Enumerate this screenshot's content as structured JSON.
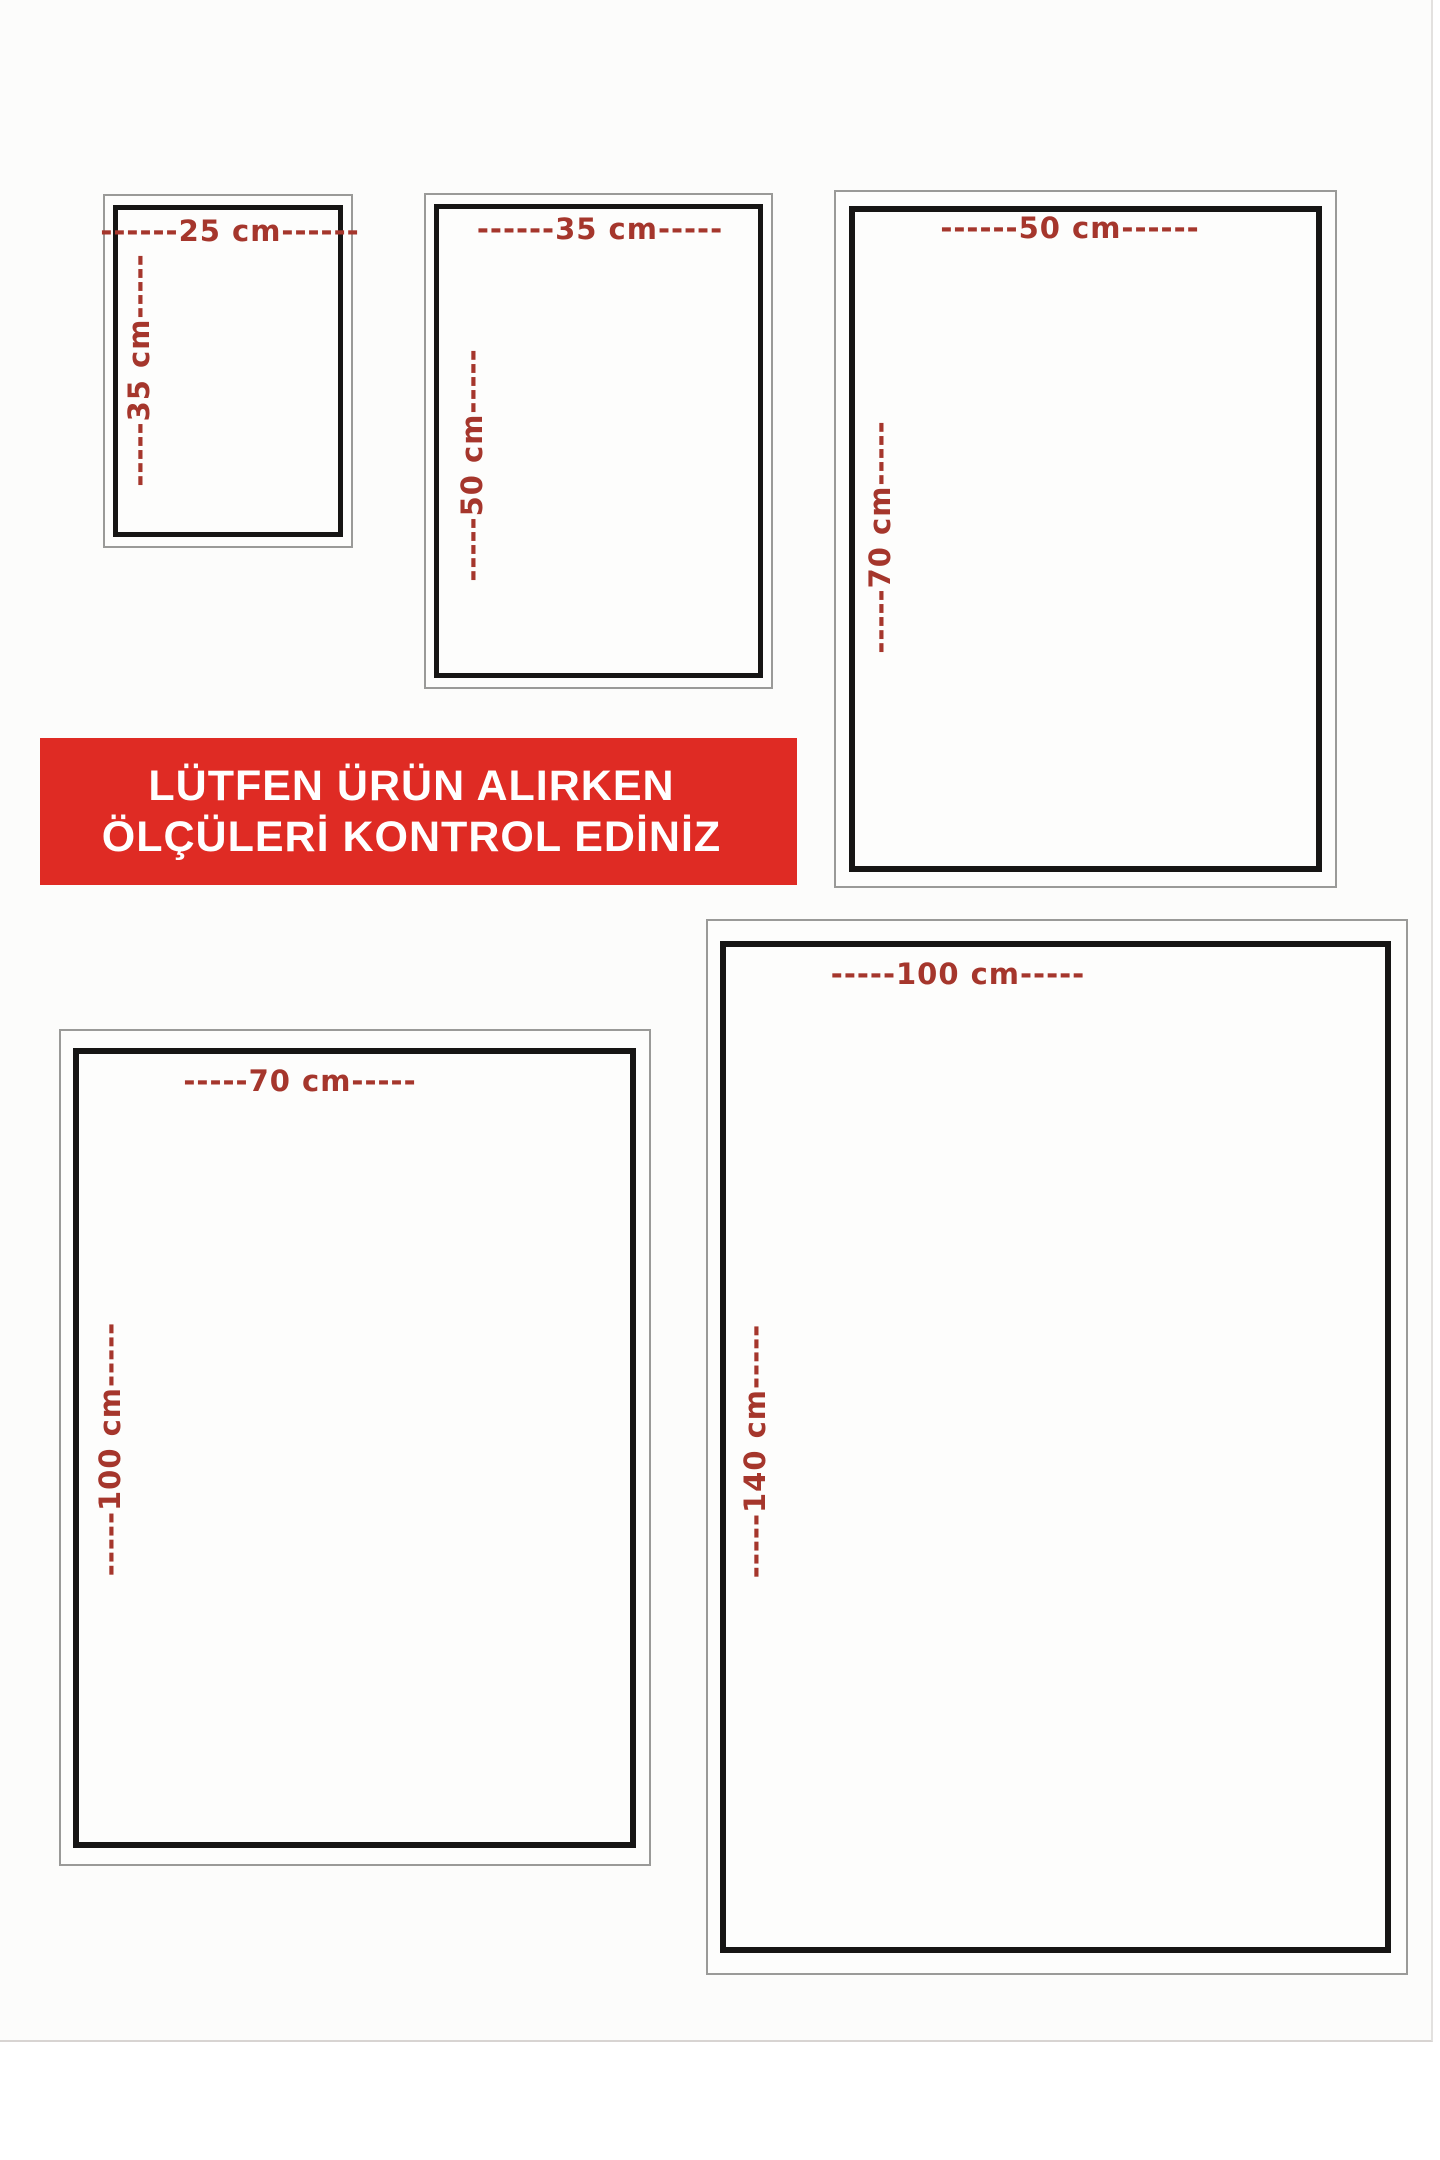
{
  "banner": {
    "line1": "LÜTFEN ÜRÜN ALIRKEN",
    "line2": "ÖLÇÜLERİ KONTROL EDİNİZ",
    "bg_color": "#df2b24",
    "text_color": "#ffffff"
  },
  "label_color": "#a5362c",
  "frame_border_color": "#161514",
  "sizes": [
    {
      "name": "25x35",
      "width_cm": 25,
      "height_cm": 35,
      "width_label": "------25 cm------",
      "height_label": "-----35 cm-----"
    },
    {
      "name": "35x50",
      "width_cm": 35,
      "height_cm": 50,
      "width_label": "------35 cm-----",
      "height_label": "-----50 cm-----"
    },
    {
      "name": "50x70",
      "width_cm": 50,
      "height_cm": 70,
      "width_label": "------50 cm------",
      "height_label": "-----70 cm-----"
    },
    {
      "name": "70x100",
      "width_cm": 70,
      "height_cm": 100,
      "width_label": "-----70 cm-----",
      "height_label": "-----100 cm-----"
    },
    {
      "name": "100x140",
      "width_cm": 100,
      "height_cm": 140,
      "width_label": "-----100 cm-----",
      "height_label": "-----140 cm-----"
    }
  ]
}
